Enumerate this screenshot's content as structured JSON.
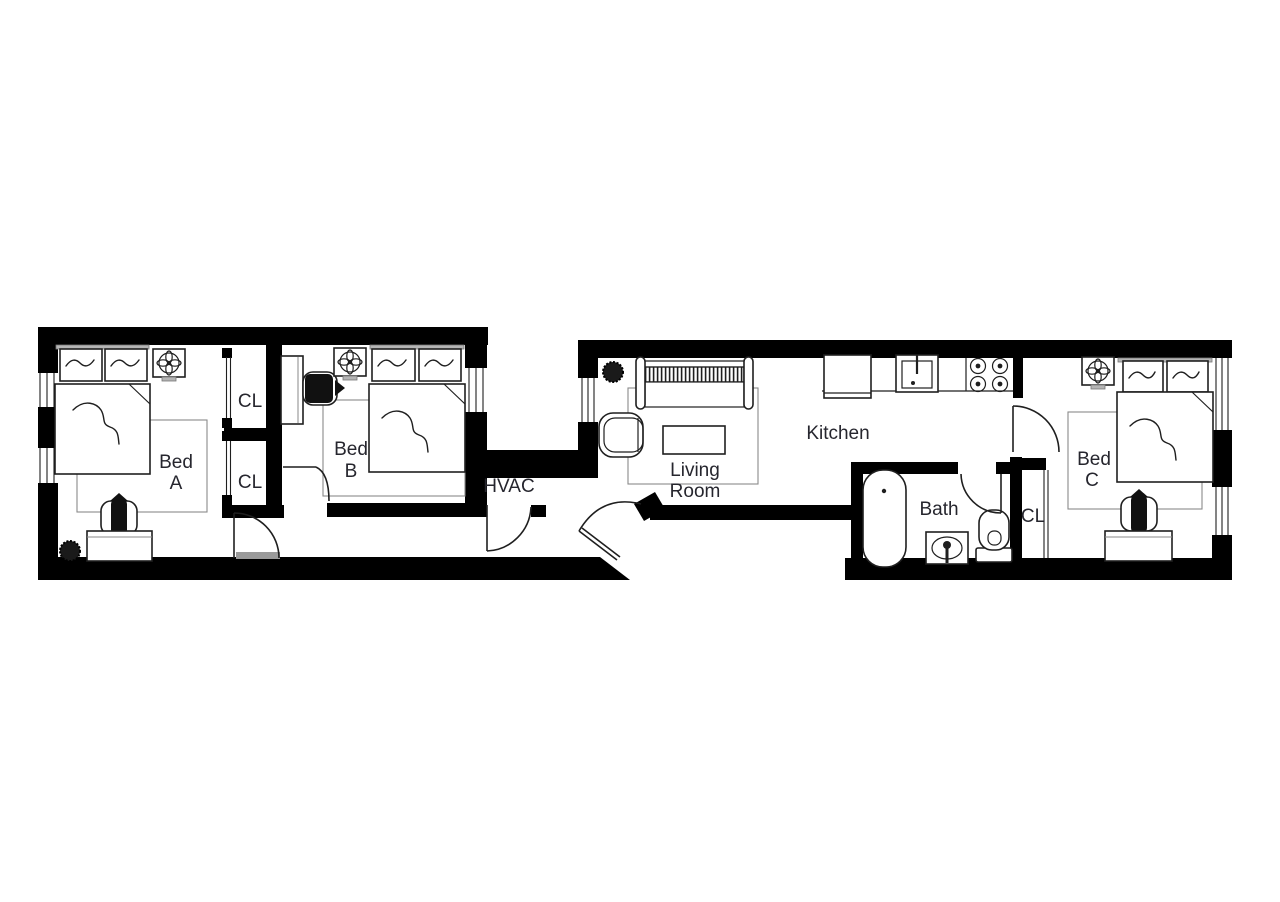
{
  "canvas": {
    "bg": "#ffffff",
    "wall_color": "#000000",
    "line_color": "#1f1f1f",
    "muted_color": "#8a8a8a",
    "label_color": "#26262e"
  },
  "plan": {
    "type": "apartment-floor-plan",
    "blocks": 2
  },
  "rooms": {
    "bed_a": {
      "label": "Bed A",
      "line1": "Bed",
      "line2": "A",
      "furniture": [
        "double-bed",
        "pillow",
        "pillow",
        "ceiling-fan",
        "rug",
        "desk",
        "office-chair",
        "plant"
      ]
    },
    "closet_upper": {
      "label": "CL"
    },
    "closet_lower": {
      "label": "CL"
    },
    "bed_b": {
      "label": "Bed B",
      "line1": "Bed",
      "line2": "B",
      "furniture": [
        "double-bed",
        "pillow",
        "pillow",
        "ceiling-fan",
        "rug",
        "desk",
        "office-chair"
      ]
    },
    "hvac": {
      "label": "HVAC"
    },
    "living_room": {
      "label": "Living Room",
      "line1": "Living",
      "line2": "Room",
      "furniture": [
        "sofa",
        "armchair",
        "coffee-table",
        "rug",
        "plant"
      ]
    },
    "kitchen": {
      "label": "Kitchen",
      "furniture": [
        "refrigerator",
        "kitchen-sink",
        "stove",
        "counter"
      ]
    },
    "bath": {
      "label": "Bath",
      "furniture": [
        "bathtub",
        "bathroom-sink",
        "toilet"
      ]
    },
    "closet_bath": {
      "label": "CL"
    },
    "bed_c": {
      "label": "Bed C",
      "line1": "Bed",
      "line2": "C",
      "furniture": [
        "double-bed",
        "pillow",
        "pillow",
        "ceiling-fan",
        "rug",
        "desk",
        "office-chair"
      ]
    }
  }
}
